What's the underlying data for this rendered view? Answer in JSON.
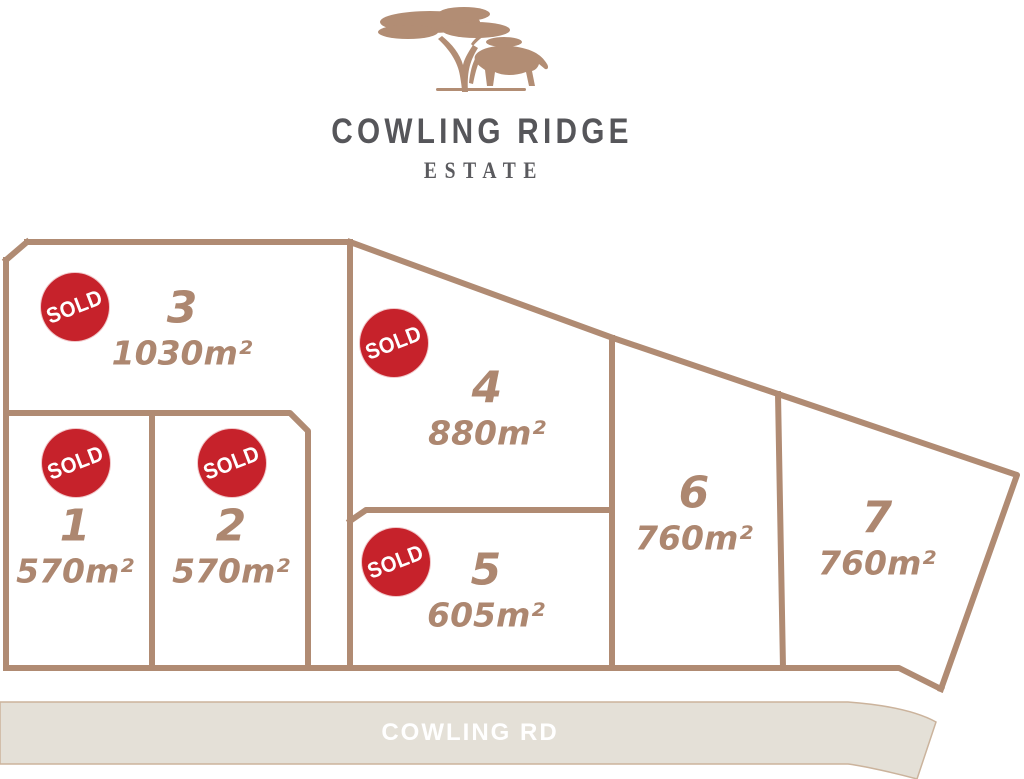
{
  "brand": {
    "title": "COWLING RIDGE",
    "subtitle": "ESTATE"
  },
  "icons": {
    "logo_tree": "acacia-tree-icon",
    "logo_animal": "bull-icon"
  },
  "badge": {
    "label": "SOLD"
  },
  "road": {
    "label": "COWLING RD"
  },
  "lots": [
    {
      "number": "1",
      "area": "570m²",
      "sold": true
    },
    {
      "number": "2",
      "area": "570m²",
      "sold": true
    },
    {
      "number": "3",
      "area": "1030m²",
      "sold": true
    },
    {
      "number": "4",
      "area": "880m²",
      "sold": true
    },
    {
      "number": "5",
      "area": "605m²",
      "sold": true
    },
    {
      "number": "6",
      "area": "760m²",
      "sold": false
    },
    {
      "number": "7",
      "area": "760m²",
      "sold": false
    }
  ],
  "colors": {
    "boundary_line": "#b08b73",
    "lot_text": "#ad8770",
    "sold_red": "#c6222b",
    "road_fill": "#e4e0d7",
    "road_text": "#ffffff",
    "title_text": "#56565a",
    "logo_tan": "#b28d74"
  }
}
